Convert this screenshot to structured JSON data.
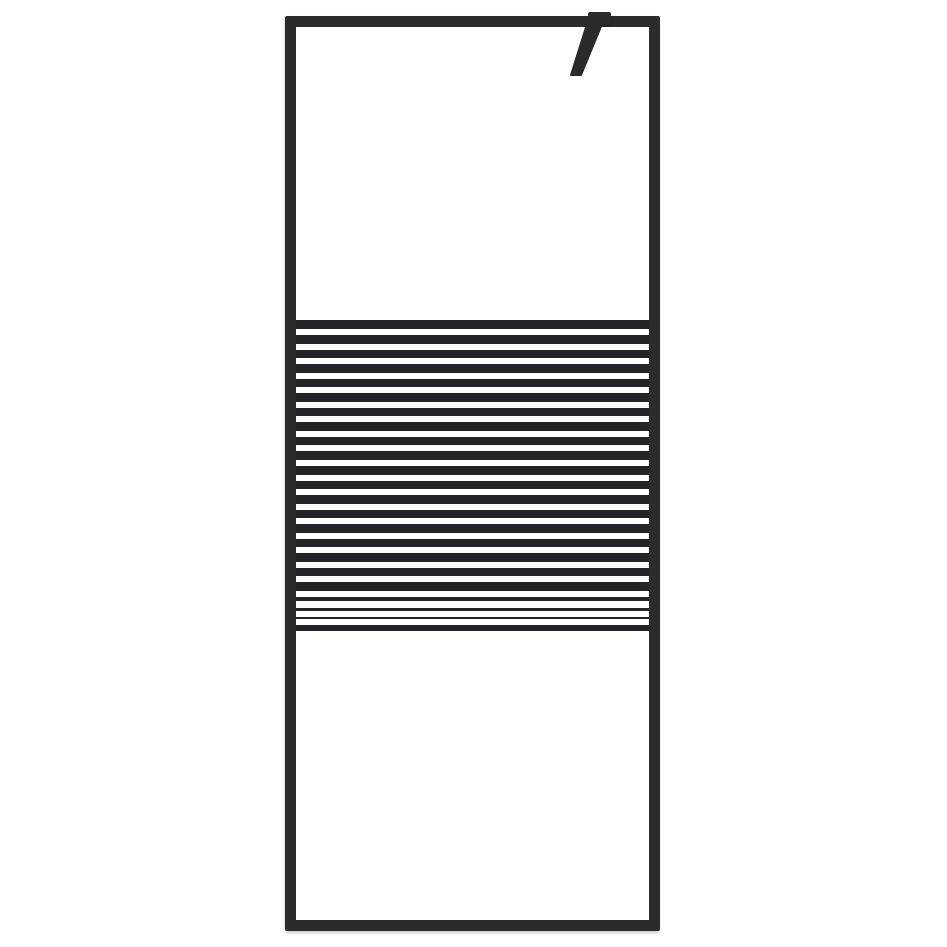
{
  "scene": {
    "kind": "product-photo",
    "subject": "walk-in-shower-glass-screen-black-frame-frosted-stripes",
    "background_color": "#ffffff"
  },
  "colors": {
    "frame": "#2b2b2e",
    "frame_highlight": "#3a3a3d",
    "stripe_dark": "#242428",
    "glass": "#ffffff"
  },
  "frame": {
    "left": 285,
    "top": 16,
    "width": 375,
    "height": 915,
    "thickness": 11
  },
  "glass_panels": {
    "upper": {
      "left": 296,
      "top": 27,
      "width": 353,
      "height": 293
    },
    "lower": {
      "left": 296,
      "top": 631,
      "width": 353,
      "height": 289
    }
  },
  "stripe_band": {
    "left": 296,
    "top": 320,
    "width": 353,
    "height": 311,
    "white_stripes": [
      {
        "y": 9,
        "h": 6
      },
      {
        "y": 24,
        "h": 6
      },
      {
        "y": 38,
        "h": 6
      },
      {
        "y": 53,
        "h": 6
      },
      {
        "y": 67,
        "h": 6
      },
      {
        "y": 82,
        "h": 6
      },
      {
        "y": 96,
        "h": 6
      },
      {
        "y": 111,
        "h": 6
      },
      {
        "y": 125,
        "h": 6
      },
      {
        "y": 140,
        "h": 6
      },
      {
        "y": 155,
        "h": 6
      },
      {
        "y": 169,
        "h": 6
      },
      {
        "y": 184,
        "h": 6
      },
      {
        "y": 198,
        "h": 6
      },
      {
        "y": 213,
        "h": 6
      },
      {
        "y": 227,
        "h": 6
      },
      {
        "y": 242,
        "h": 6
      },
      {
        "y": 256,
        "h": 6
      },
      {
        "y": 271,
        "h": 6
      },
      {
        "y": 281,
        "h": 7
      },
      {
        "y": 291,
        "h": 6
      },
      {
        "y": 299,
        "h": 6
      }
    ]
  },
  "mount_bracket": {
    "block": {
      "left": 588,
      "top": 12,
      "width": 23,
      "height": 13
    },
    "arm_points": "587,24 602,24 581,75 571,75"
  }
}
